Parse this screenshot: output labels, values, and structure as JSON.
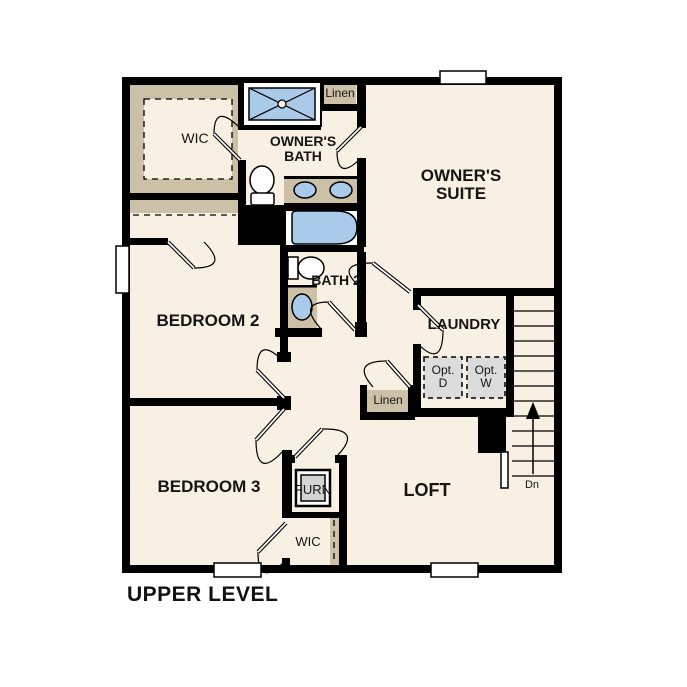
{
  "title": "UPPER LEVEL",
  "colors": {
    "wall": "#000000",
    "floor": "#f7f0e3",
    "casework_tan": "#ccc0a6",
    "fixture_blue": "#a9cbe9",
    "appliance_gray": "#dcdcdc"
  },
  "rooms": {
    "wic_upper": "WIC",
    "owners_bath": "OWNER'S BATH",
    "linen_upper": "Linen",
    "owners_suite": "OWNER'S SUITE",
    "bedroom2": "BEDROOM 2",
    "bath2": "BATH 2",
    "laundry": "LAUNDRY",
    "linen_hall": "Linen",
    "bedroom3": "BEDROOM 3",
    "furn": "FURN",
    "wic_lower": "WIC",
    "loft": "LOFT"
  },
  "appliances": {
    "optional_dryer": "Opt. D",
    "optional_washer": "Opt. W"
  },
  "stairs": {
    "direction_label": "Dn"
  }
}
